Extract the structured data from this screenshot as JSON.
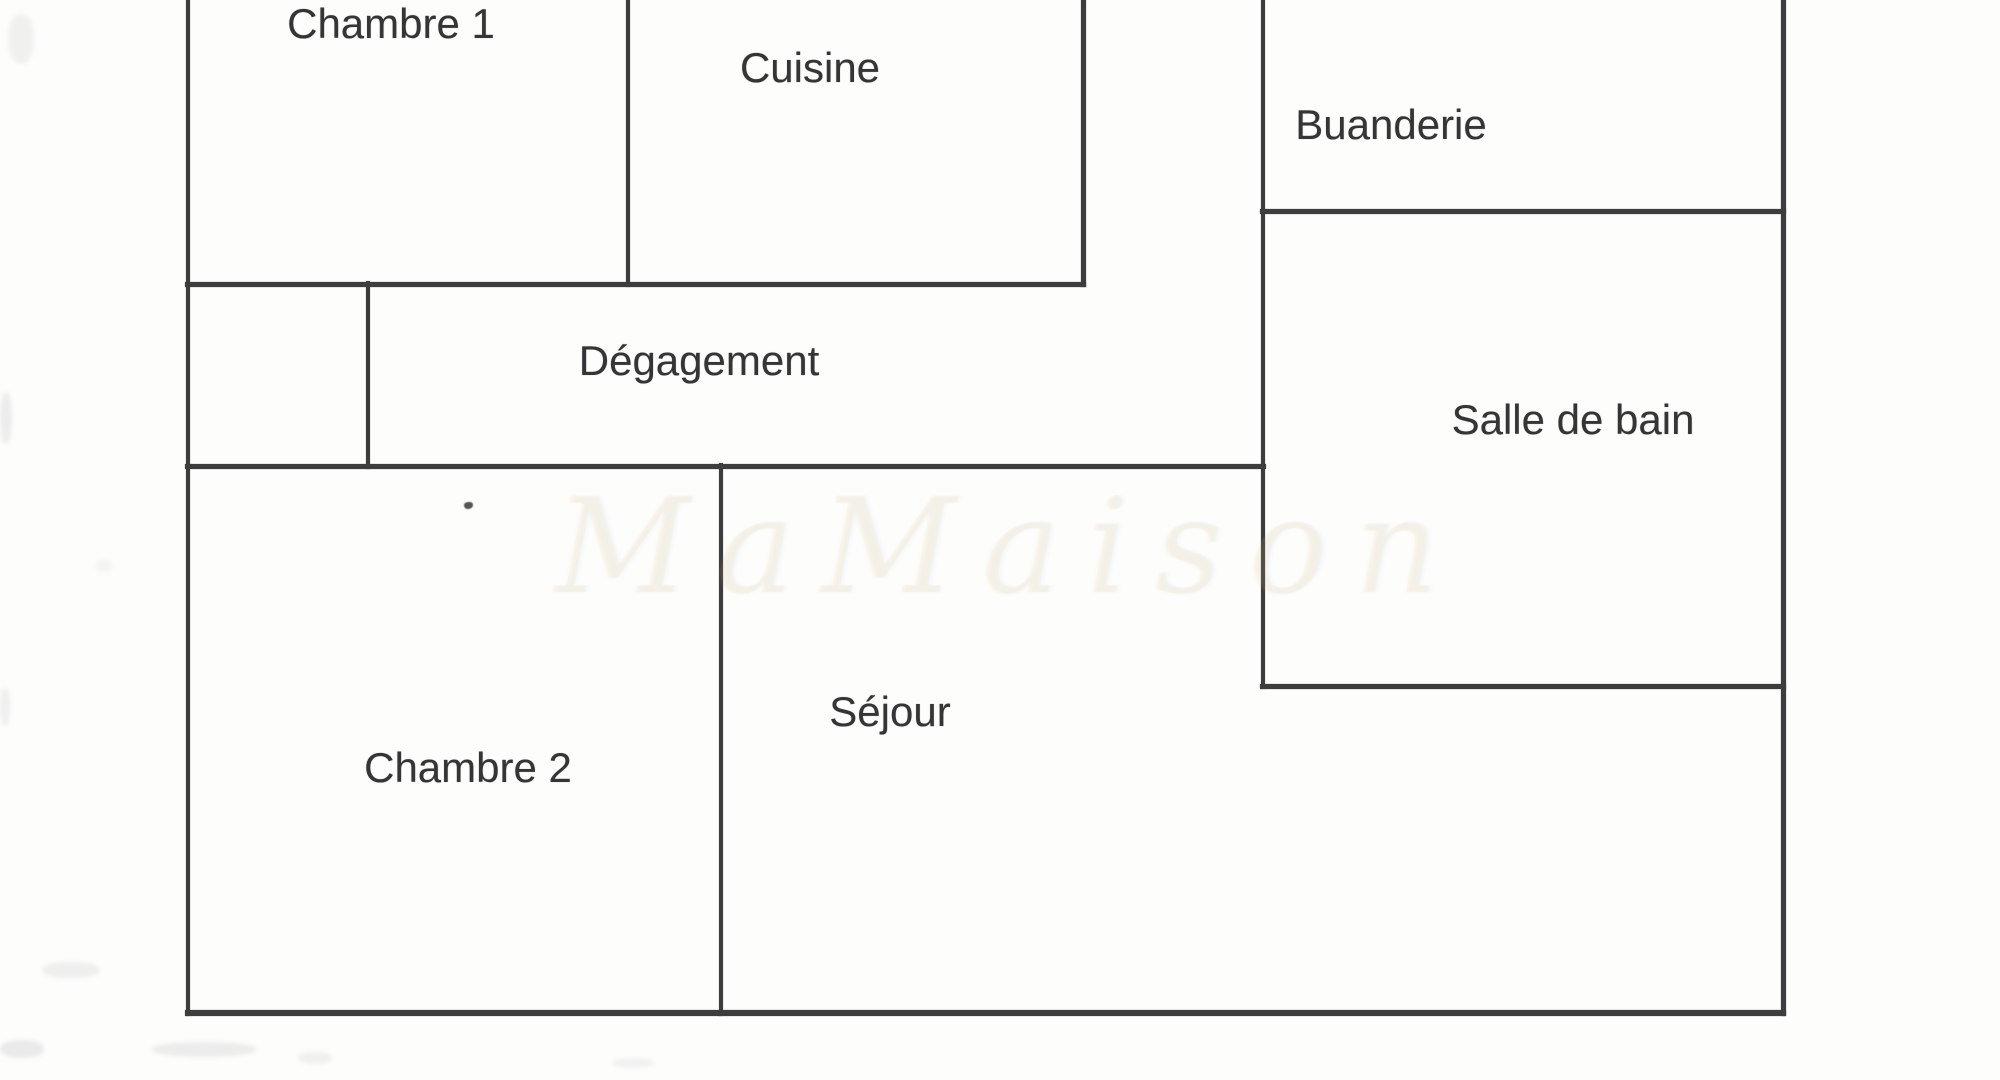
{
  "title": "Plan d'appartement",
  "colors": {
    "background": "#fdfdfc",
    "wall": "#3d3d3d",
    "label": "#353535",
    "watermark": "#e8a654"
  },
  "canvas": {
    "width": 2000,
    "height": 1080
  },
  "rooms": [
    {
      "id": "chambre-1",
      "label": "Chambre 1",
      "label_x": 391,
      "label_y": 24
    },
    {
      "id": "cuisine",
      "label": "Cuisine",
      "label_x": 810,
      "label_y": 68
    },
    {
      "id": "buanderie",
      "label": "Buanderie",
      "label_x": 1391,
      "label_y": 125
    },
    {
      "id": "degagement",
      "label": "Dégagement",
      "label_x": 699,
      "label_y": 361
    },
    {
      "id": "salle-de-bain",
      "label": "Salle de bain",
      "label_x": 1573,
      "label_y": 420
    },
    {
      "id": "chambre-2",
      "label": "Chambre 2",
      "label_x": 468,
      "label_y": 768
    },
    {
      "id": "sejour",
      "label": "Séjour",
      "label_x": 890,
      "label_y": 712
    }
  ],
  "walls": {
    "vertical": [
      {
        "name": "outer-left",
        "x": 188,
        "y1": 0,
        "y2": 1013,
        "t": 4
      },
      {
        "name": "chambre1-cuisine",
        "x": 628,
        "y1": 0,
        "y2": 284,
        "t": 4
      },
      {
        "name": "cuisine-right",
        "x": 1083,
        "y1": 0,
        "y2": 284,
        "t": 5
      },
      {
        "name": "buanderie-sdb-left",
        "x": 1263,
        "y1": 0,
        "y2": 686,
        "t": 4
      },
      {
        "name": "outer-right",
        "x": 1783,
        "y1": 0,
        "y2": 1013,
        "t": 5
      },
      {
        "name": "placard-right",
        "x": 368,
        "y1": 284,
        "y2": 466,
        "t": 4
      },
      {
        "name": "chambre2-sejour",
        "x": 721,
        "y1": 466,
        "y2": 1013,
        "t": 4
      }
    ],
    "horizontal": [
      {
        "name": "chambre1-cuisine-bottom",
        "y": 284,
        "x1": 188,
        "x2": 1083,
        "t": 5
      },
      {
        "name": "buanderie-bottom",
        "y": 211,
        "x1": 1263,
        "x2": 1783,
        "t": 5
      },
      {
        "name": "degagement-bottom",
        "y": 466,
        "x1": 188,
        "x2": 1263,
        "t": 5
      },
      {
        "name": "salle-de-bain-bottom",
        "y": 686,
        "x1": 1263,
        "x2": 1783,
        "t": 5
      },
      {
        "name": "plan-bottom",
        "y": 1013,
        "x1": 188,
        "x2": 1783,
        "t": 6
      }
    ]
  },
  "watermark": {
    "text": "MaMaison"
  },
  "artifacts": {
    "speck": {
      "x": 464,
      "y": 502,
      "w": 9,
      "h": 7
    },
    "smudges": [
      {
        "x": 8,
        "y": 14,
        "w": 26,
        "h": 50,
        "o": 0.1
      },
      {
        "x": 0,
        "y": 392,
        "w": 12,
        "h": 52,
        "o": 0.14
      },
      {
        "x": 96,
        "y": 560,
        "w": 16,
        "h": 12,
        "o": 0.08
      },
      {
        "x": 0,
        "y": 688,
        "w": 10,
        "h": 38,
        "o": 0.12
      },
      {
        "x": 42,
        "y": 962,
        "w": 58,
        "h": 16,
        "o": 0.12
      },
      {
        "x": 0,
        "y": 1040,
        "w": 44,
        "h": 18,
        "o": 0.16
      },
      {
        "x": 152,
        "y": 1042,
        "w": 104,
        "h": 15,
        "o": 0.14
      },
      {
        "x": 298,
        "y": 1052,
        "w": 34,
        "h": 12,
        "o": 0.11
      },
      {
        "x": 612,
        "y": 1058,
        "w": 42,
        "h": 10,
        "o": 0.1
      }
    ]
  }
}
